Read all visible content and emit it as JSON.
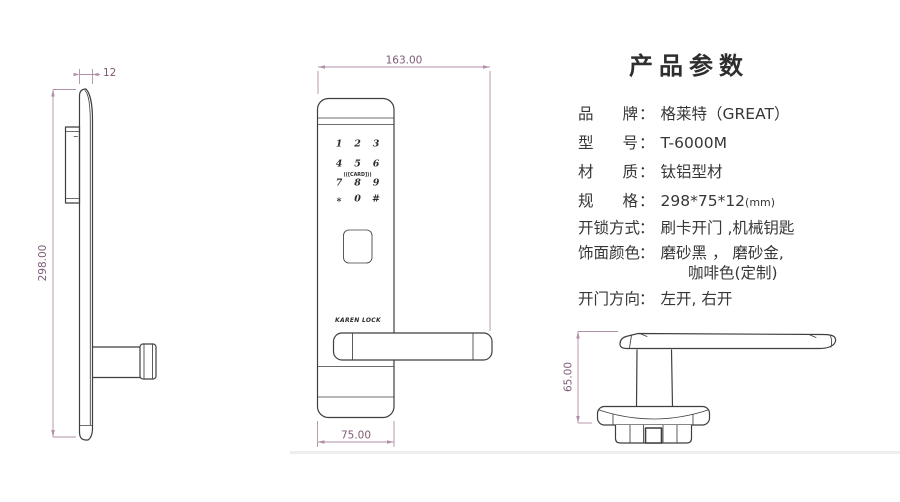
{
  "title": "产品参数",
  "colon": "：",
  "specs": [
    {
      "label": "品牌",
      "value": "格莱特（GREAT）"
    },
    {
      "label": "型号",
      "value": "T-6000M"
    },
    {
      "label": "材质",
      "value": "钛铝型材"
    },
    {
      "label": "规格",
      "value": "298*75*12",
      "unit": "(mm)"
    },
    {
      "label": "开锁方式",
      "value": "刷卡开门 ,机械钥匙"
    },
    {
      "label": "饰面颜色",
      "value": "磨砂黑 ， 磨砂金,",
      "value2": "咖啡色(定制)"
    },
    {
      "label": "开门方向",
      "value": "左开, 右开"
    }
  ],
  "dimensions": {
    "side_thickness": "12",
    "side_height": "298.00",
    "front_total_width": "163.00",
    "front_body_width": "75.00",
    "handle_height": "65.00"
  },
  "front_view": {
    "brand": "KAREN LOCK",
    "card_label": "(([CARD]))",
    "keypad": [
      "1",
      "2",
      "3",
      "4",
      "5",
      "6",
      "7",
      "8",
      "9",
      "*",
      "0",
      "#"
    ]
  },
  "colors": {
    "outline": "#3f3f3f",
    "dimension_line": "#b18fa9",
    "dimension_text": "#7e5b76",
    "text": "#373737",
    "background": "#ffffff"
  }
}
